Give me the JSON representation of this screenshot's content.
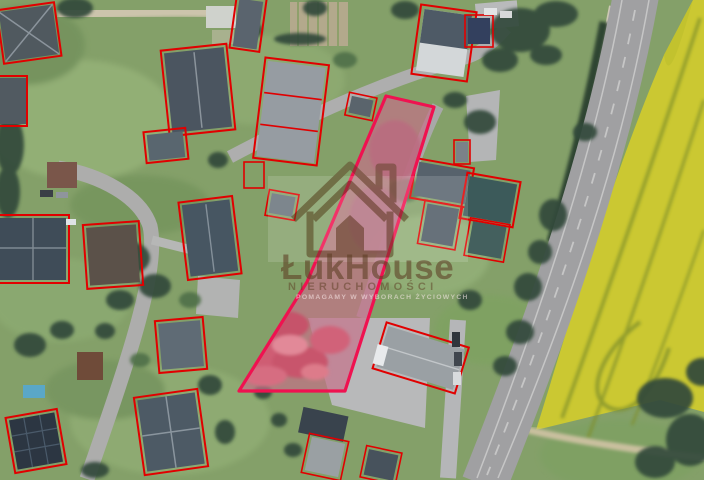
{
  "watermark": {
    "brand": "ŁukHouse",
    "subtitle": "NIERUCHOMOŚCI",
    "tagline": "POMAGAMY W WYBORACH ŻYCIOWYCH"
  },
  "colors": {
    "building-outline": "#e10000",
    "parcel-stroke": "#ef1250",
    "parcel-fill": "rgba(233,78,128,0.30)",
    "grass": "#84a069",
    "field": "#cbc832",
    "road": "#a0a0a2",
    "watermark": "#5d3f24"
  }
}
